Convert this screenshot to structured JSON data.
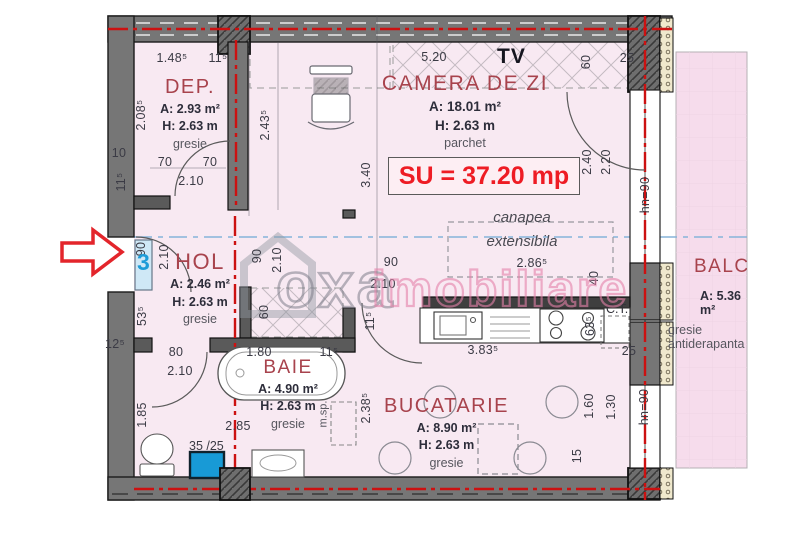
{
  "plan_title": "apartment floor plan",
  "rooms": {
    "dep": {
      "name": "DEP.",
      "area": "A: 2.93 m²",
      "height": "H: 2.63 m",
      "floor": "gresie"
    },
    "camera": {
      "name": "CAMERA DE ZI",
      "area": "A: 18.01 m²",
      "height": "H: 2.63 m",
      "floor": "parchet"
    },
    "hol": {
      "name": "HOL",
      "area": "A: 2.46 m²",
      "height": "H: 2.63 m",
      "floor": "gresie"
    },
    "baie": {
      "name": "BAIE",
      "area": "A: 4.90 m²",
      "height": "H: 2.63 m",
      "floor": "gresie"
    },
    "bucatarie": {
      "name": "BUCATARIE",
      "area": "A: 8.90 m²",
      "height": "H: 2.63 m",
      "floor": "gresie"
    },
    "balcon": {
      "name": "BALCON",
      "area": "A: 5.36 m²",
      "floor": "gresie antiderapanta"
    }
  },
  "annotations": {
    "su_total": "SU = 37.20 mp",
    "tv": "TV",
    "sofa_line1": "canapea",
    "sofa_line2": "extensibila",
    "boiler": "C.T.",
    "washing_machine": "m.sp.",
    "shaft": "35 /25",
    "door_number": "3"
  },
  "watermark": {
    "word1": "oxa",
    "word2": "imobiliare"
  },
  "dimensions": [
    {
      "t": "1.48⁵",
      "x": 172,
      "y": 58
    },
    {
      "t": "11⁵",
      "x": 218,
      "y": 58
    },
    {
      "t": "2.08⁵",
      "x": 141,
      "y": 115,
      "r": 1
    },
    {
      "t": "10",
      "x": 119,
      "y": 153
    },
    {
      "t": "70",
      "x": 165,
      "y": 162
    },
    {
      "t": "70",
      "x": 210,
      "y": 162
    },
    {
      "t": "2.10",
      "x": 191,
      "y": 181
    },
    {
      "t": "11⁵",
      "x": 121,
      "y": 182,
      "r": 1
    },
    {
      "t": "2.43⁵",
      "x": 265,
      "y": 125,
      "r": 1
    },
    {
      "t": "3.40",
      "x": 366,
      "y": 175,
      "r": 1
    },
    {
      "t": "5.20",
      "x": 434,
      "y": 57
    },
    {
      "t": "60",
      "x": 586,
      "y": 62,
      "r": 1
    },
    {
      "t": "25",
      "x": 627,
      "y": 58
    },
    {
      "t": "2.40",
      "x": 587,
      "y": 162,
      "r": 1
    },
    {
      "t": "2.20",
      "x": 606,
      "y": 162,
      "r": 1
    },
    {
      "t": "hn=90",
      "x": 645,
      "y": 195,
      "r": 1
    },
    {
      "t": "90",
      "x": 141,
      "y": 249,
      "r": 1
    },
    {
      "t": "2.10",
      "x": 164,
      "y": 257,
      "r": 1
    },
    {
      "t": "53⁵",
      "x": 142,
      "y": 316,
      "r": 1
    },
    {
      "t": "12⁵",
      "x": 115,
      "y": 344
    },
    {
      "t": "90",
      "x": 257,
      "y": 256,
      "r": 1
    },
    {
      "t": "2.10",
      "x": 277,
      "y": 260,
      "r": 1
    },
    {
      "t": "60",
      "x": 264,
      "y": 312,
      "r": 1
    },
    {
      "t": "90",
      "x": 391,
      "y": 262
    },
    {
      "t": "2.10",
      "x": 383,
      "y": 284
    },
    {
      "t": "11⁵",
      "x": 370,
      "y": 321,
      "r": 1
    },
    {
      "t": "2.86⁵",
      "x": 532,
      "y": 263
    },
    {
      "t": "40",
      "x": 594,
      "y": 278,
      "r": 1
    },
    {
      "t": "80",
      "x": 176,
      "y": 352
    },
    {
      "t": "2.10",
      "x": 180,
      "y": 371
    },
    {
      "t": "1.80",
      "x": 259,
      "y": 352
    },
    {
      "t": "11⁵",
      "x": 329,
      "y": 352
    },
    {
      "t": "1.85",
      "x": 142,
      "y": 415,
      "r": 1
    },
    {
      "t": "2.85",
      "x": 238,
      "y": 426
    },
    {
      "t": "2.38⁵",
      "x": 366,
      "y": 408,
      "r": 1
    },
    {
      "t": "3.83⁵",
      "x": 483,
      "y": 350
    },
    {
      "t": "63⁵",
      "x": 590,
      "y": 326,
      "r": 1
    },
    {
      "t": "25",
      "x": 629,
      "y": 351
    },
    {
      "t": "1.60",
      "x": 589,
      "y": 406,
      "r": 1
    },
    {
      "t": "1.30",
      "x": 611,
      "y": 407,
      "r": 1
    },
    {
      "t": "15",
      "x": 577,
      "y": 456,
      "r": 1
    },
    {
      "t": "hn=90",
      "x": 644,
      "y": 407,
      "r": 1
    }
  ],
  "colors": {
    "room_fill": "#f8e9f2",
    "balcony_fill": "#f6dcec",
    "wall_grey": "#767676",
    "axis_red": "#cc1111",
    "su_red": "#ee1c24",
    "door_blue": "#1e9cd8",
    "section_blue": "#85b4d9"
  }
}
